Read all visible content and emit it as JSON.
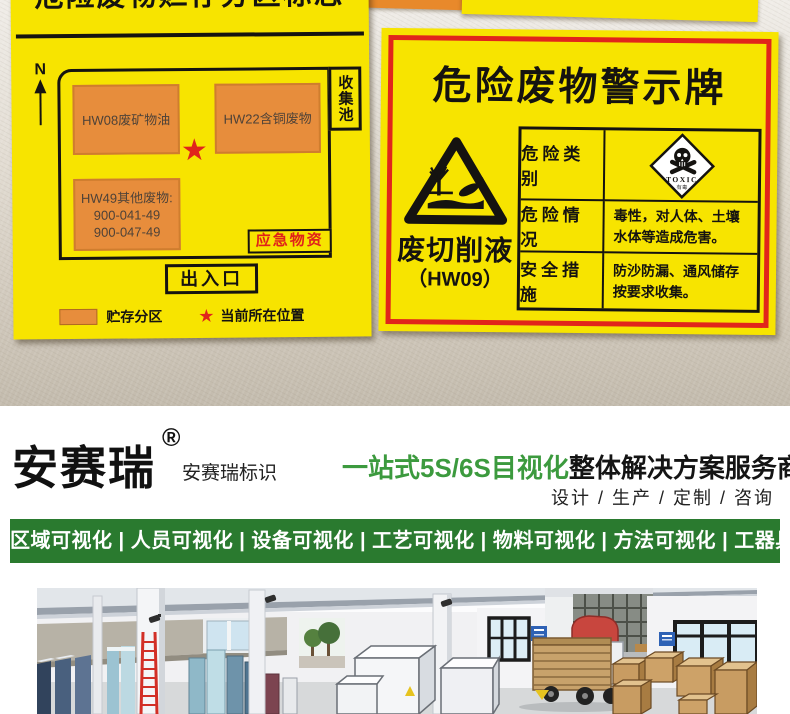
{
  "colors": {
    "sign_yellow": "#f7e400",
    "zone_orange": "#e78d3c",
    "accent_red": "#e1251b",
    "banner_green": "#2a7a2f",
    "tagline_green": "#3c9a3e"
  },
  "left_sign": {
    "title": "危险废物贮存分区标志",
    "compass_n": "N",
    "zone1": "HW08废矿物油",
    "zone2": "HW22含铜废物",
    "zone3_line1": "HW49其他废物:",
    "zone3_line2": "900-041-49",
    "zone3_line3": "900-047-49",
    "collection_pool": "收集池",
    "emergency": "应急物资",
    "entrance": "出入口",
    "star": "★",
    "legend_zone": "贮存分区",
    "legend_star": "★",
    "legend_location": "当前所在位置"
  },
  "right_sign": {
    "title": "危险废物警示牌",
    "waste_name": "废切削液",
    "waste_code": "（HW09）",
    "row1_label": "危险类别",
    "toxic_text": "TOXIC",
    "toxic_sub": "有毒",
    "row2_label": "危险情况",
    "row2_line1": "毒性，对人体、土壤",
    "row2_line2": "水体等造成危害。",
    "row3_label": "安全措施",
    "row3_line1": "防沙防漏、通风储存",
    "row3_line2": "按要求收集。"
  },
  "footer": {
    "logo_text": "安赛瑞",
    "logo_reg": "®",
    "logo_sub": "安赛瑞标识",
    "tagline_green": "一站式5S/6S目视化",
    "tagline_black": "整体解决方案服务商",
    "services": "设计 / 生产 / 定制 / 咨询",
    "banner": "区域可视化 | 人员可视化 | 设备可视化 | 工艺可视化 | 物料可视化 | 方法可视化 | 工器具可视化"
  }
}
